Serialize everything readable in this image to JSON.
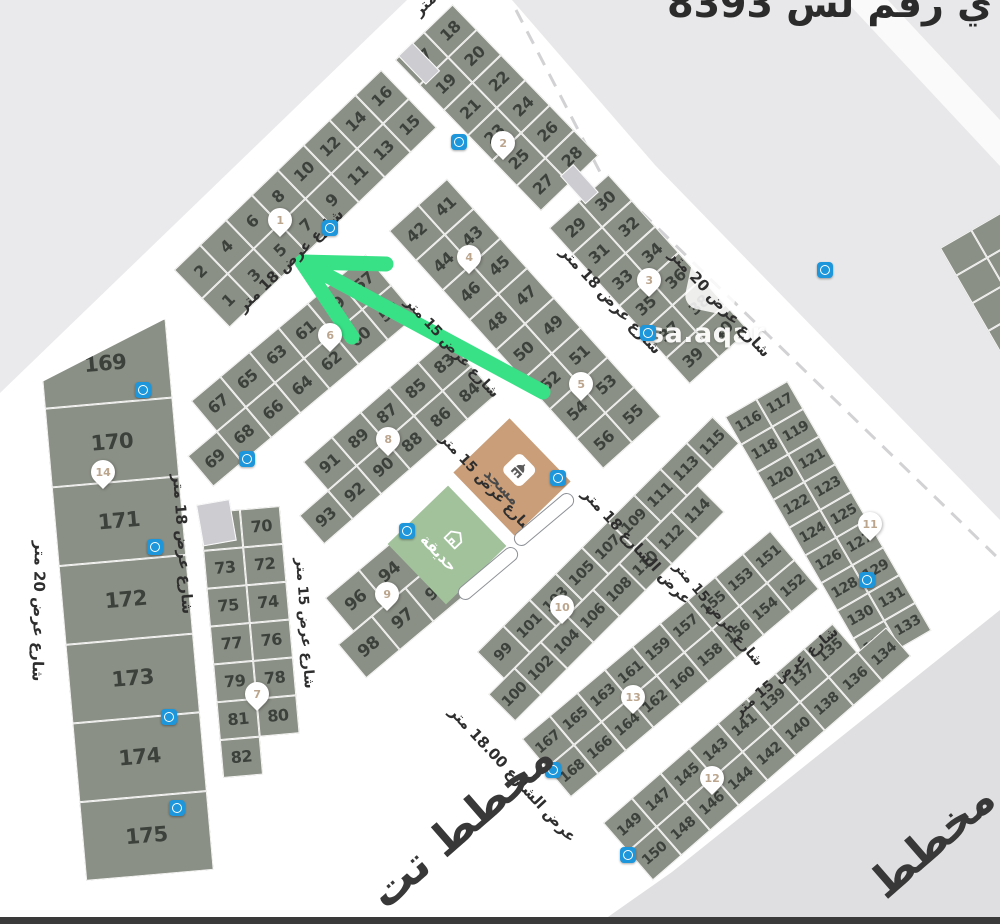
{
  "header": {
    "title": "ي رقم لس 8393"
  },
  "watermark": {
    "text": "sa.aqar"
  },
  "footer": {
    "fragments": [
      {
        "text": "مخطط تت",
        "x": 393,
        "y": 918,
        "rot": -41,
        "fs": 44
      },
      {
        "text": "مخطط",
        "x": 893,
        "y": 908,
        "rot": -41,
        "fs": 44
      }
    ]
  },
  "landmarks": {
    "mosque": {
      "label": "مسجد"
    },
    "garden": {
      "label": "حديقة"
    }
  },
  "map": {
    "colors": {
      "plot": "#8b9086",
      "plot_number": "#3c413c",
      "mosque": "#c99e78",
      "garden": "#a2c29c",
      "arrow": "#38e186",
      "marker": "#1d96dc",
      "pin_text": "#bba58d",
      "street": "#ffffff",
      "outside_top_left": "#eaeaec",
      "outside_top_right": "#e8e8ea",
      "outside_bottom_right": "#dfdfe1"
    },
    "blocks": [
      {
        "name": "block-1-16",
        "x": 174,
        "y": 270,
        "rot": -44,
        "cw": 36,
        "ch": 40,
        "fs": 16,
        "rows": [
          [
            "2",
            "4",
            "6",
            "8",
            "10",
            "12",
            "14",
            "16"
          ],
          [
            "1",
            "3",
            "5",
            "7",
            "9",
            "11",
            "13",
            "15"
          ]
        ]
      },
      {
        "name": "block-17-28",
        "x": 395,
        "y": 60,
        "rot": -44,
        "cw": 40,
        "ch": 35,
        "fs": 16,
        "rows": [
          [
            "17",
            "18"
          ],
          [
            "19",
            "20"
          ],
          [
            "21",
            "22"
          ],
          [
            "23",
            "24"
          ],
          [
            "25",
            "26"
          ],
          [
            "27",
            "28"
          ]
        ]
      },
      {
        "name": "block-29-40",
        "x": 549,
        "y": 228,
        "rot": -42,
        "cw": 40,
        "ch": 35,
        "fs": 16,
        "rows": [
          [
            "29",
            "30"
          ],
          [
            "31",
            "32"
          ],
          [
            "33",
            "34"
          ],
          [
            "35",
            "36"
          ],
          [
            "37",
            "38"
          ],
          [
            "39",
            "40"
          ]
        ]
      },
      {
        "name": "block-41-56",
        "x": 389,
        "y": 231,
        "rot": -42,
        "cw": 39,
        "ch": 40,
        "fs": 16,
        "rows": [
          [
            "42",
            "41"
          ],
          [
            "44",
            "43"
          ],
          [
            "46",
            "45"
          ],
          [
            "48",
            "47"
          ],
          [
            "50",
            "49"
          ],
          [
            "52",
            "51"
          ],
          [
            "54",
            "53"
          ],
          [
            "56",
            "55"
          ]
        ]
      },
      {
        "name": "block-57-69",
        "x": 191,
        "y": 401,
        "rot": -40,
        "cw": 38,
        "ch": 40,
        "fs": 16,
        "row_dx": [
          0,
          -38
        ],
        "rows": [
          [
            "67",
            "65",
            "63",
            "61",
            "59",
            "57"
          ],
          [
            "69",
            "68",
            "66",
            "64",
            "62",
            "60",
            "58"
          ]
        ]
      },
      {
        "name": "block-70-82",
        "x": 200,
        "y": 513,
        "rot": -5,
        "cw": 40,
        "ch": 38,
        "fs": 16,
        "rows": [
          [
            "71",
            "70"
          ],
          [
            "73",
            "72"
          ],
          [
            "75",
            "74"
          ],
          [
            "77",
            "76"
          ],
          [
            "79",
            "78"
          ],
          [
            "81",
            "80"
          ],
          [
            "82",
            null
          ]
        ]
      },
      {
        "name": "block-83-93",
        "x": 303,
        "y": 462,
        "rot": -41,
        "cw": 38,
        "ch": 38,
        "fs": 16,
        "row_dx": [
          0,
          -38
        ],
        "rows": [
          [
            "91",
            "89",
            "87",
            "85",
            "83"
          ],
          [
            "93",
            "92",
            "90",
            "88",
            "86",
            "84"
          ]
        ]
      },
      {
        "name": "block-94-98",
        "x": 325,
        "y": 598,
        "rot": -40,
        "cw": 44,
        "ch": 44,
        "fs": 17,
        "row_dx": [
          0,
          -20
        ],
        "rows": [
          [
            "96",
            "94"
          ],
          [
            "98",
            "97",
            "95"
          ]
        ]
      },
      {
        "name": "block-99-115",
        "x": 477,
        "y": 652,
        "rot": -45,
        "cw": 37,
        "ch": 38,
        "fs": 14.5,
        "row_dx": [
          0,
          -22
        ],
        "rows": [
          [
            "99",
            "101",
            "103",
            "105",
            "107",
            "109",
            "111",
            "113",
            "115"
          ],
          [
            "100",
            "102",
            "104",
            "106",
            "108",
            "110",
            "112",
            "114"
          ]
        ]
      },
      {
        "name": "block-116-133",
        "x": 725,
        "y": 417,
        "rot": -30,
        "cw": 36,
        "ch": 32,
        "fs": 14,
        "rows": [
          [
            "116",
            "117"
          ],
          [
            "118",
            "119"
          ],
          [
            "120",
            "121"
          ],
          [
            "122",
            "123"
          ],
          [
            "124",
            "125"
          ],
          [
            "126",
            "127"
          ],
          [
            "128",
            "129"
          ],
          [
            "130",
            "131"
          ],
          [
            "132",
            "133"
          ]
        ]
      },
      {
        "name": "block-151-168",
        "x": 522,
        "y": 739,
        "rot": -40,
        "cw": 36,
        "ch": 38,
        "fs": 14,
        "rows": [
          [
            "167",
            "165",
            "163",
            "161",
            "159",
            "157",
            "155",
            "153",
            "151"
          ],
          [
            "168",
            "166",
            "164",
            "162",
            "160",
            "158",
            "156",
            "154",
            "152"
          ]
        ]
      },
      {
        "name": "block-134-150",
        "x": 603,
        "y": 823,
        "rot": -41,
        "cw": 38,
        "ch": 38,
        "fs": 14,
        "rows": [
          [
            "149",
            "147",
            "145",
            "143",
            "141",
            "139",
            "137",
            "135",
            null
          ],
          [
            "150",
            "148",
            "146",
            "144",
            "142",
            "140",
            "138",
            "136",
            "134"
          ]
        ]
      },
      {
        "name": "block-169-175",
        "x": 38,
        "y": 330,
        "rot": -5,
        "cw": 128,
        "ch": 79,
        "fs": 21,
        "clip": "polygon(0 52px, 100% 0, 100% 100%, 0 100%)",
        "rows": [
          [
            "169"
          ],
          [
            "170"
          ],
          [
            "171"
          ],
          [
            "172"
          ],
          [
            "173"
          ],
          [
            "174"
          ],
          [
            "175"
          ]
        ]
      },
      {
        "name": "block-edge-partial",
        "x": 940,
        "y": 248,
        "rot": -30,
        "cw": 36,
        "ch": 32,
        "fs": 14,
        "rows": [
          [
            "",
            ""
          ],
          [
            "",
            ""
          ],
          [
            "",
            ""
          ],
          [
            "",
            ""
          ]
        ]
      },
      {
        "name": "alley-gap-1",
        "x": 398,
        "y": 56,
        "rot": -44,
        "cw": 20,
        "ch": 40,
        "light": true,
        "rows": [
          [
            ""
          ]
        ]
      },
      {
        "name": "alley-gap-2",
        "x": 560,
        "y": 176,
        "rot": -42,
        "cw": 18,
        "ch": 38,
        "light": true,
        "rows": [
          [
            ""
          ]
        ]
      },
      {
        "name": "alley-gap-3",
        "x": 196,
        "y": 505,
        "rot": -10,
        "cw": 34,
        "ch": 42,
        "light": true,
        "rows": [
          [
            ""
          ]
        ]
      }
    ],
    "street_labels": [
      {
        "text": "شارع عرض 18 متر",
        "x": 240,
        "y": 300,
        "rot": -44,
        "fs": 15
      },
      {
        "text": "شارع عرض 18 متر",
        "x": 178,
        "y": 465,
        "rot": 86,
        "fs": 15
      },
      {
        "text": "شارع عرض 18 متر",
        "x": 563,
        "y": 240,
        "rot": 47,
        "fs": 15
      },
      {
        "text": "عرض الشارع 18 متر",
        "x": 585,
        "y": 482,
        "rot": 47,
        "fs": 15
      },
      {
        "text": "عرض الشارع 18.00 متر",
        "x": 452,
        "y": 700,
        "rot": 47,
        "fs": 15
      },
      {
        "text": "شارع عرض 15 متر",
        "x": 407,
        "y": 292,
        "rot": 47,
        "fs": 14
      },
      {
        "text": "شارع عرض 15 متر",
        "x": 442,
        "y": 428,
        "rot": 47,
        "fs": 14
      },
      {
        "text": "شارع عرض 15 متر",
        "x": 300,
        "y": 550,
        "rot": 86,
        "fs": 14
      },
      {
        "text": "شارع عرض 15 متر",
        "x": 676,
        "y": 556,
        "rot": 50,
        "fs": 14
      },
      {
        "text": "شارع عرض 15 متر",
        "x": 736,
        "y": 706,
        "rot": -40,
        "fs": 14
      },
      {
        "text": "شارع عرض 20 متر",
        "x": 672,
        "y": 243,
        "rot": 47,
        "fs": 15
      },
      {
        "text": "شارع عرض 20 متر",
        "x": 40,
        "y": 532,
        "rot": 91,
        "fs": 15
      },
      {
        "text": "متر",
        "x": 416,
        "y": 4,
        "rot": -44,
        "fs": 15
      }
    ],
    "pins": [
      {
        "n": "1",
        "x": 280,
        "y": 223
      },
      {
        "n": "2",
        "x": 503,
        "y": 146
      },
      {
        "n": "3",
        "x": 649,
        "y": 283
      },
      {
        "n": "4",
        "x": 469,
        "y": 260
      },
      {
        "n": "5",
        "x": 581,
        "y": 387
      },
      {
        "n": "6",
        "x": 330,
        "y": 338
      },
      {
        "n": "7",
        "x": 257,
        "y": 697
      },
      {
        "n": "8",
        "x": 388,
        "y": 442
      },
      {
        "n": "9",
        "x": 387,
        "y": 597
      },
      {
        "n": "10",
        "x": 562,
        "y": 610
      },
      {
        "n": "11",
        "x": 870,
        "y": 527
      },
      {
        "n": "12",
        "x": 712,
        "y": 781
      },
      {
        "n": "13",
        "x": 633,
        "y": 700
      },
      {
        "n": "14",
        "x": 103,
        "y": 475
      }
    ],
    "markers": [
      {
        "x": 459,
        "y": 142
      },
      {
        "x": 330,
        "y": 228
      },
      {
        "x": 825,
        "y": 270
      },
      {
        "x": 648,
        "y": 333
      },
      {
        "x": 247,
        "y": 459
      },
      {
        "x": 143,
        "y": 390
      },
      {
        "x": 155,
        "y": 547
      },
      {
        "x": 169,
        "y": 717
      },
      {
        "x": 177,
        "y": 808
      },
      {
        "x": 407,
        "y": 531
      },
      {
        "x": 558,
        "y": 478
      },
      {
        "x": 867,
        "y": 580
      },
      {
        "x": 553,
        "y": 770
      },
      {
        "x": 628,
        "y": 855
      }
    ],
    "capsules": [
      {
        "cx": 487,
        "cy": 573,
        "rot": -40
      },
      {
        "cx": 543,
        "cy": 519,
        "rot": -40
      }
    ],
    "arrow": {
      "shaft": [
        [
          543,
          392
        ],
        [
          302,
          262
        ]
      ],
      "barbs": [
        [
          386,
          264
        ],
        [
          352,
          337
        ]
      ]
    },
    "dash_line": [
      [
        516,
        10
      ],
      [
        600,
        172
      ],
      [
        1000,
        560
      ]
    ]
  }
}
